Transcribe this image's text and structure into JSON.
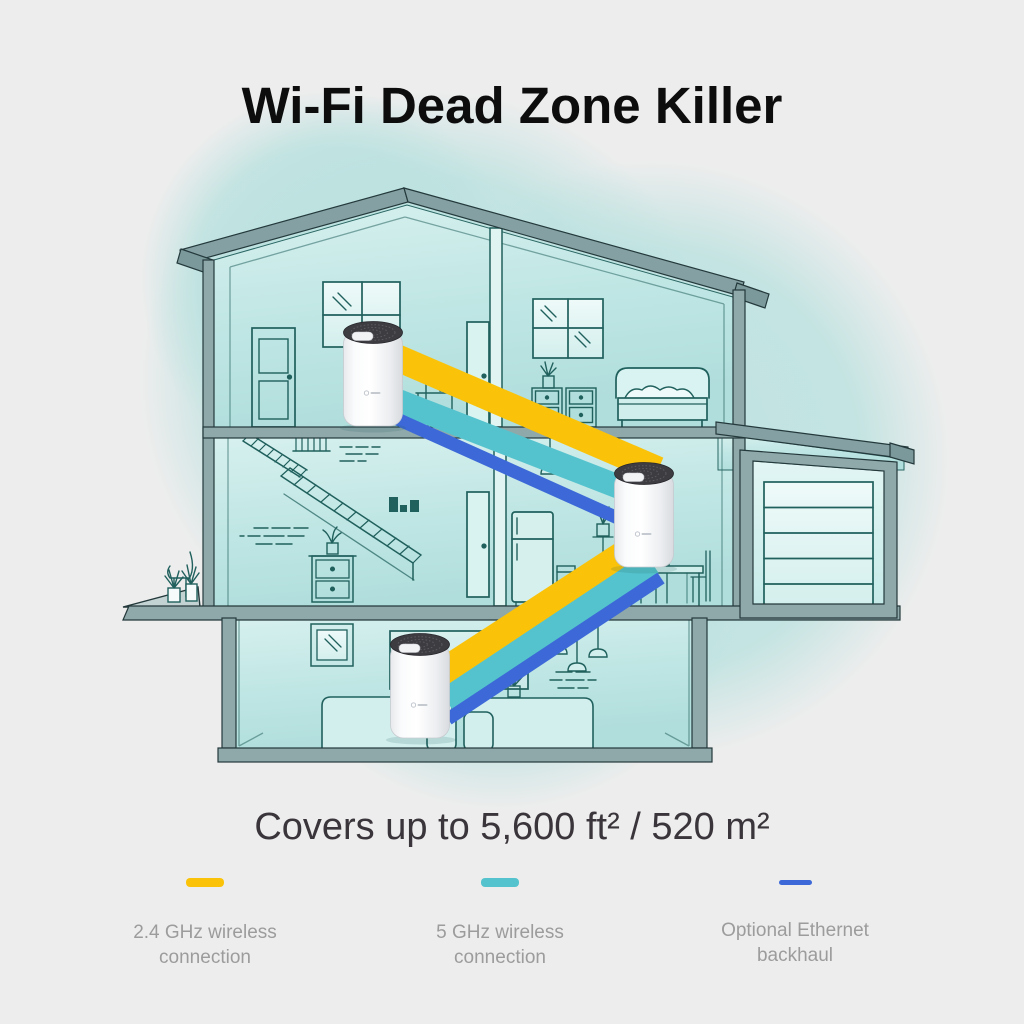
{
  "title": "Wi-Fi Dead Zone Killer",
  "coverage_caption": "Covers up to 5,600 ft² / 520 m²",
  "legend": {
    "items": [
      {
        "name": "2.4ghz-wireless",
        "color": "#fac30a",
        "label_line1": "2.4 GHz wireless",
        "label_line2": "connection"
      },
      {
        "name": "5ghz-wireless",
        "color": "#55c3cd",
        "label_line1": "5 GHz wireless",
        "label_line2": "connection"
      },
      {
        "name": "ethernet-backhaul",
        "color": "#3c69d7",
        "label_line1": "Optional Ethernet",
        "label_line2": "backhaul"
      }
    ]
  },
  "illustration": {
    "description": "Cutaway three-story house with three Deco mesh Wi-Fi units linked by 2.4 GHz, 5 GHz and Ethernet backhaul bands",
    "deco_unit_count": 3,
    "colors": {
      "band_24ghz": "#fac30a",
      "band_5ghz": "#55c3cd",
      "band_ethernet": "#3c69d7",
      "house_frame": "#8fa8aa",
      "room_tint": "#bfe4e2",
      "line_art": "#20605d",
      "background": "#ededed"
    }
  }
}
